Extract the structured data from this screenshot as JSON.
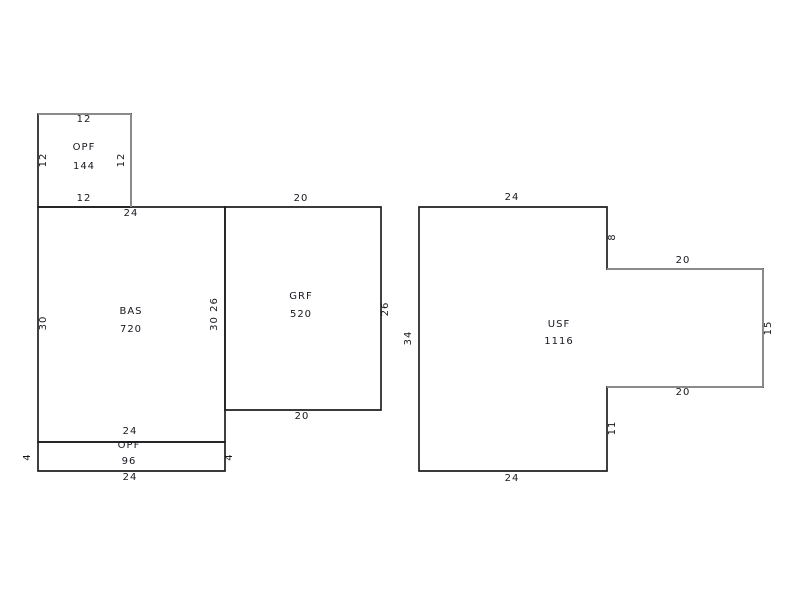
{
  "canvas": {
    "width": 800,
    "height": 600,
    "background": "#ffffff",
    "line_color": "#1f1f1f",
    "gray_line_color": "#8a8a8a",
    "text_color": "#17171f"
  },
  "sketch": {
    "areas": [
      {
        "id": "opf-upper",
        "code": "OPF",
        "area_value": "144",
        "points": "38,114 131,114 131,207 38,207",
        "dimensions": {
          "top": "12",
          "right": "12",
          "bottom": "12",
          "left": "12"
        }
      },
      {
        "id": "bas",
        "code": "BAS",
        "area_value": "720",
        "points": "38,207 225,207 225,442 38,442",
        "dimensions": {
          "top": "24",
          "right": "30 26",
          "bottom": "24",
          "left": "30"
        }
      },
      {
        "id": "grf",
        "code": "GRF",
        "area_value": "520",
        "points": "225,207 381,207 381,410 225,410",
        "dimensions": {
          "top": "20",
          "right": "26",
          "bottom": "20",
          "left": "26"
        }
      },
      {
        "id": "opf-lower",
        "code": "OPF",
        "area_value": "96",
        "points": "38,442 225,442 225,471 38,471",
        "dimensions": {
          "top": "24",
          "right": "4",
          "bottom": "24",
          "left": "4"
        }
      },
      {
        "id": "usf",
        "code": "USF",
        "area_value": "1116",
        "points": "419,207 607,207 607,269 763,269 763,387 607,387 607,471 419,471",
        "dimensions": {
          "top": "24",
          "upper_right": "8",
          "notch_top": "20",
          "right": "15",
          "notch_bottom": "20",
          "lower_right": "11",
          "bottom": "24",
          "left": "34"
        }
      }
    ],
    "gray_edges": [
      {
        "x1": 38,
        "y1": 114,
        "x2": 131,
        "y2": 114
      },
      {
        "x1": 131,
        "y1": 114,
        "x2": 131,
        "y2": 207
      },
      {
        "x1": 607,
        "y1": 269,
        "x2": 763,
        "y2": 269
      },
      {
        "x1": 763,
        "y1": 269,
        "x2": 763,
        "y2": 387
      },
      {
        "x1": 607,
        "y1": 387,
        "x2": 763,
        "y2": 387
      }
    ],
    "labels": [
      {
        "t": "12",
        "x": 84,
        "y": 120,
        "r": 0,
        "k": "dim"
      },
      {
        "t": "OPF",
        "x": 84,
        "y": 148,
        "r": 0,
        "k": "code"
      },
      {
        "t": "144",
        "x": 84,
        "y": 167,
        "r": 0,
        "k": "value"
      },
      {
        "t": "12",
        "x": 84,
        "y": 199,
        "r": 0,
        "k": "dim"
      },
      {
        "t": "12",
        "x": 44,
        "y": 160,
        "r": -90,
        "k": "dim"
      },
      {
        "t": "12",
        "x": 122,
        "y": 160,
        "r": -90,
        "k": "dim"
      },
      {
        "t": "24",
        "x": 131,
        "y": 214,
        "r": 0,
        "k": "dim"
      },
      {
        "t": "BAS",
        "x": 131,
        "y": 312,
        "r": 0,
        "k": "code"
      },
      {
        "t": "720",
        "x": 131,
        "y": 330,
        "r": 0,
        "k": "value"
      },
      {
        "t": "30",
        "x": 44,
        "y": 323,
        "r": -90,
        "k": "dim"
      },
      {
        "t": "30 26",
        "x": 215,
        "y": 314,
        "r": -90,
        "k": "dim"
      },
      {
        "t": "24",
        "x": 130,
        "y": 432,
        "r": 0,
        "k": "dim"
      },
      {
        "t": "OPF",
        "x": 129,
        "y": 446,
        "r": 0,
        "k": "code"
      },
      {
        "t": "96",
        "x": 129,
        "y": 462,
        "r": 0,
        "k": "value"
      },
      {
        "t": "24",
        "x": 130,
        "y": 478,
        "r": 0,
        "k": "dim"
      },
      {
        "t": "4",
        "x": 28,
        "y": 457,
        "r": -90,
        "k": "dim"
      },
      {
        "t": "4",
        "x": 230,
        "y": 457,
        "r": -90,
        "k": "dim"
      },
      {
        "t": "20",
        "x": 301,
        "y": 199,
        "r": 0,
        "k": "dim"
      },
      {
        "t": "GRF",
        "x": 301,
        "y": 297,
        "r": 0,
        "k": "code"
      },
      {
        "t": "520",
        "x": 301,
        "y": 315,
        "r": 0,
        "k": "value"
      },
      {
        "t": "26",
        "x": 386,
        "y": 309,
        "r": -90,
        "k": "dim"
      },
      {
        "t": "20",
        "x": 302,
        "y": 417,
        "r": 0,
        "k": "dim"
      },
      {
        "t": "24",
        "x": 512,
        "y": 198,
        "r": 0,
        "k": "dim"
      },
      {
        "t": "8",
        "x": 613,
        "y": 237,
        "r": -90,
        "k": "dim"
      },
      {
        "t": "20",
        "x": 683,
        "y": 261,
        "r": 0,
        "k": "dim"
      },
      {
        "t": "15",
        "x": 769,
        "y": 328,
        "r": -90,
        "k": "dim"
      },
      {
        "t": "USF",
        "x": 559,
        "y": 325,
        "r": 0,
        "k": "code"
      },
      {
        "t": "1116",
        "x": 559,
        "y": 342,
        "r": 0,
        "k": "value"
      },
      {
        "t": "20",
        "x": 683,
        "y": 393,
        "r": 0,
        "k": "dim"
      },
      {
        "t": "11",
        "x": 613,
        "y": 428,
        "r": -90,
        "k": "dim"
      },
      {
        "t": "34",
        "x": 409,
        "y": 338,
        "r": -90,
        "k": "dim"
      },
      {
        "t": "24",
        "x": 512,
        "y": 479,
        "r": 0,
        "k": "dim"
      }
    ]
  }
}
